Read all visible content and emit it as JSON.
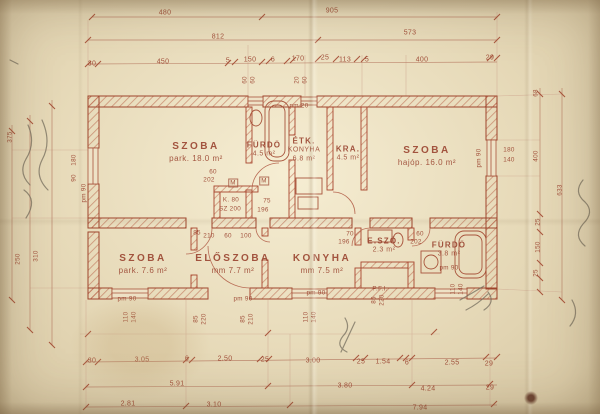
{
  "palette": {
    "paper": "#e6d9ba",
    "ink": "#9c4632",
    "ink_light": "#c49280",
    "pencil": "#6f6859"
  },
  "plan": {
    "rooms": [
      {
        "lines": [
          "SZOBA",
          "park. 18.0 m²"
        ],
        "x": 196,
        "y": 152
      },
      {
        "lines": [
          "FÜRDŐ",
          "4.5 m²"
        ],
        "x": 264,
        "y": 150,
        "sm": 1
      },
      {
        "lines": [
          "ÉTK.",
          "KONYHA",
          "6.8 m²"
        ],
        "x": 304,
        "y": 150,
        "sm": 1
      },
      {
        "lines": [
          "KRA.",
          "4.5 m²"
        ],
        "x": 348,
        "y": 154,
        "sm": 1
      },
      {
        "lines": [
          "SZOBA",
          "hajóp. 16.0 m²"
        ],
        "x": 427,
        "y": 156
      },
      {
        "lines": [
          "SZOBA",
          "park. 7.6 m²"
        ],
        "x": 143,
        "y": 264
      },
      {
        "lines": [
          "ELŐSZOBA",
          "mm 7.7 m²"
        ],
        "x": 233,
        "y": 264
      },
      {
        "lines": [
          "KONYHA",
          "mm 7.5 m²"
        ],
        "x": 322,
        "y": 264
      },
      {
        "lines": [
          "E.SZŐ.",
          "2.3 m²"
        ],
        "x": 384,
        "y": 246,
        "sm": 1
      },
      {
        "lines": [
          "FÜRDŐ",
          "3.8 m²"
        ],
        "x": 449,
        "y": 250,
        "sm": 1
      }
    ],
    "dims": [
      {
        "t": "480",
        "x": 165,
        "y": 13
      },
      {
        "t": "905",
        "x": 332,
        "y": 11
      },
      {
        "t": "812",
        "x": 218,
        "y": 37
      },
      {
        "t": "573",
        "x": 410,
        "y": 33
      },
      {
        "t": "30",
        "x": 92,
        "y": 64
      },
      {
        "t": "450",
        "x": 163,
        "y": 62
      },
      {
        "t": "5",
        "x": 228,
        "y": 61
      },
      {
        "t": "150",
        "x": 250,
        "y": 60
      },
      {
        "t": "6",
        "x": 273,
        "y": 60
      },
      {
        "t": "170",
        "x": 298,
        "y": 59
      },
      {
        "t": "25",
        "x": 325,
        "y": 58
      },
      {
        "t": "113",
        "x": 345,
        "y": 60
      },
      {
        "t": "5",
        "x": 367,
        "y": 60
      },
      {
        "t": "400",
        "x": 422,
        "y": 60
      },
      {
        "t": "29",
        "x": 490,
        "y": 58
      },
      {
        "t": "30",
        "x": 92,
        "y": 361
      },
      {
        "t": "3.05",
        "x": 142,
        "y": 360
      },
      {
        "t": "6",
        "x": 187,
        "y": 359
      },
      {
        "t": "2.50",
        "x": 225,
        "y": 359
      },
      {
        "t": "25",
        "x": 265,
        "y": 360
      },
      {
        "t": "3.00",
        "x": 313,
        "y": 361
      },
      {
        "t": "25",
        "x": 361,
        "y": 362
      },
      {
        "t": "1.54",
        "x": 383,
        "y": 362
      },
      {
        "t": "6",
        "x": 407,
        "y": 363
      },
      {
        "t": "2.55",
        "x": 452,
        "y": 363
      },
      {
        "t": "29",
        "x": 489,
        "y": 364
      },
      {
        "t": "5.91",
        "x": 177,
        "y": 384
      },
      {
        "t": "3.80",
        "x": 345,
        "y": 386
      },
      {
        "t": "4.24",
        "x": 428,
        "y": 389
      },
      {
        "t": "29",
        "x": 490,
        "y": 388
      },
      {
        "t": "2.81",
        "x": 128,
        "y": 404
      },
      {
        "t": "3.10",
        "x": 214,
        "y": 405
      },
      {
        "t": "7.94",
        "x": 420,
        "y": 408
      }
    ],
    "verticals": [
      {
        "t": "375",
        "x": 10,
        "y": 137
      },
      {
        "t": "250",
        "x": 18,
        "y": 259
      },
      {
        "t": "310",
        "x": 36,
        "y": 256
      },
      {
        "t": "180",
        "x": 74,
        "y": 160
      },
      {
        "t": "90",
        "x": 74,
        "y": 178
      },
      {
        "t": "pm 90",
        "x": 84,
        "y": 193
      },
      {
        "t": "110",
        "x": 126,
        "y": 317
      },
      {
        "t": "140",
        "x": 134,
        "y": 317
      },
      {
        "t": "85",
        "x": 196,
        "y": 319
      },
      {
        "t": "220",
        "x": 204,
        "y": 319
      },
      {
        "t": "85",
        "x": 243,
        "y": 319
      },
      {
        "t": "210",
        "x": 251,
        "y": 319
      },
      {
        "t": "110",
        "x": 306,
        "y": 317
      },
      {
        "t": "140",
        "x": 314,
        "y": 317
      },
      {
        "t": "85",
        "x": 374,
        "y": 300
      },
      {
        "t": "220",
        "x": 382,
        "y": 300
      },
      {
        "t": "110",
        "x": 453,
        "y": 289
      },
      {
        "t": "140",
        "x": 461,
        "y": 289
      },
      {
        "t": "60",
        "x": 245,
        "y": 80
      },
      {
        "t": "60",
        "x": 253,
        "y": 80
      },
      {
        "t": "20",
        "x": 297,
        "y": 80
      },
      {
        "t": "60",
        "x": 305,
        "y": 80
      },
      {
        "t": "pm 90",
        "x": 479,
        "y": 158
      },
      {
        "t": "68",
        "x": 536,
        "y": 93
      },
      {
        "t": "400",
        "x": 536,
        "y": 156
      },
      {
        "t": "633",
        "x": 560,
        "y": 190
      },
      {
        "t": "25",
        "x": 538,
        "y": 222
      },
      {
        "t": "150",
        "x": 538,
        "y": 247
      },
      {
        "t": "25",
        "x": 536,
        "y": 273
      }
    ],
    "specs": [
      {
        "t": "pm 20",
        "x": 299,
        "y": 106
      },
      {
        "t": "60",
        "x": 213,
        "y": 172
      },
      {
        "t": "202",
        "x": 209,
        "y": 180
      },
      {
        "t": "M",
        "x": 233,
        "y": 183,
        "box": 1
      },
      {
        "t": "M",
        "x": 264,
        "y": 181,
        "box": 1
      },
      {
        "t": "K. 80",
        "x": 231,
        "y": 200
      },
      {
        "t": "SZ 200",
        "x": 230,
        "y": 209
      },
      {
        "t": "75",
        "x": 267,
        "y": 201
      },
      {
        "t": "196",
        "x": 263,
        "y": 210
      },
      {
        "t": "85",
        "x": 197,
        "y": 233
      },
      {
        "t": "210",
        "x": 209,
        "y": 236
      },
      {
        "t": "60",
        "x": 228,
        "y": 236
      },
      {
        "t": "100",
        "x": 246,
        "y": 236
      },
      {
        "t": "70",
        "x": 350,
        "y": 234
      },
      {
        "t": "196",
        "x": 344,
        "y": 242
      },
      {
        "t": "60",
        "x": 420,
        "y": 234
      },
      {
        "t": "202",
        "x": 416,
        "y": 242
      },
      {
        "t": "180",
        "x": 509,
        "y": 150
      },
      {
        "t": "140",
        "x": 509,
        "y": 160
      },
      {
        "t": "P.F.I.",
        "x": 380,
        "y": 289
      },
      {
        "t": "pm 90",
        "x": 127,
        "y": 299
      },
      {
        "t": "pm 90",
        "x": 243,
        "y": 299
      },
      {
        "t": "pm 90",
        "x": 316,
        "y": 293
      },
      {
        "t": "pm 90",
        "x": 449,
        "y": 268
      }
    ]
  }
}
